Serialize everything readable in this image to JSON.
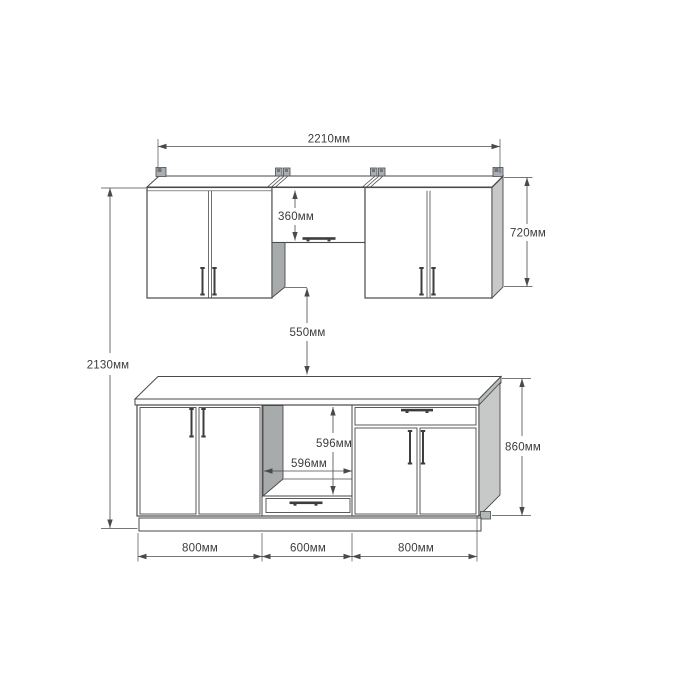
{
  "drawing": {
    "type": "kitchen-cabinet-elevation",
    "unit_suffix": "мм"
  },
  "labels": {
    "total_width": "2210мм",
    "total_height": "2130мм",
    "wall_cabinet_height": "720мм",
    "wall_middle_section_height": "360мм",
    "wall_to_counter_gap": "550мм",
    "oven_niche_height": "596мм",
    "oven_niche_width": "596мм",
    "base_cabinet_height": "860мм",
    "base_left_section_width": "800мм",
    "base_middle_section_width": "600мм",
    "base_right_section_width": "800мм"
  },
  "colors": {
    "line": "#4a4a4a",
    "text": "#3c3c3c",
    "end_panel_gray": "#c7c9c8",
    "inner_panel_gray": "#a7abac",
    "counter_edge_gray": "#b9bcbb",
    "bracket_gray": "#aaaeb2",
    "handle_dark": "#3d3d3d",
    "background": "#ffffff"
  }
}
